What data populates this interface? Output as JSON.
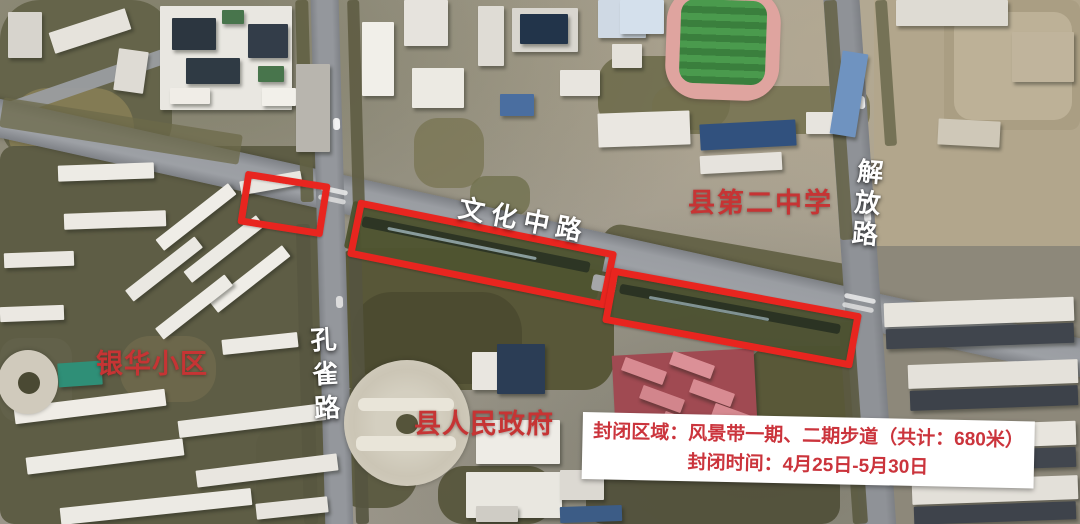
{
  "map": {
    "road_labels": [
      {
        "id": "wenhua-zhong-road",
        "text": "文化中路",
        "orientation": "horizontal"
      },
      {
        "id": "kongque-road",
        "text": "孔雀路",
        "orientation": "vertical"
      },
      {
        "id": "jiefang-road",
        "text": "解放路",
        "orientation": "vertical"
      }
    ],
    "place_labels": [
      {
        "id": "county-no2-middle-school",
        "text": "县第二中学"
      },
      {
        "id": "yinhua-residential-district",
        "text": "银华小区"
      },
      {
        "id": "county-peoples-government",
        "text": "县人民政府"
      }
    ]
  },
  "notice": {
    "line1": "封闭区域：风景带一期、二期步道（共计：680米）",
    "line2": "封闭时间：4月25日-5月30日"
  },
  "annotations": {
    "closed_zone_count": 3,
    "closed_zone_color": "#e8251f"
  },
  "colors": {
    "place_label_red": "#c63434",
    "road_label_white": "#ffffff",
    "notice_text_red": "#cb343c",
    "notice_background": "#ffffff"
  }
}
